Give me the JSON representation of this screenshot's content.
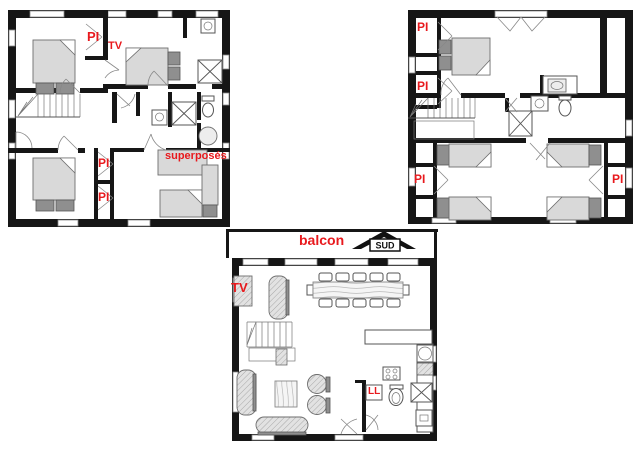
{
  "labels": {
    "placard": "PI",
    "tv": "TV",
    "bunks": "superposés",
    "balcony": "balcon",
    "south": "SUD",
    "washer": "LL"
  },
  "colors": {
    "wall": "#161616",
    "label_red": "#e8191d",
    "furniture_fill": "#d9d9d9",
    "pillow_dark": "#8f8f8f"
  }
}
